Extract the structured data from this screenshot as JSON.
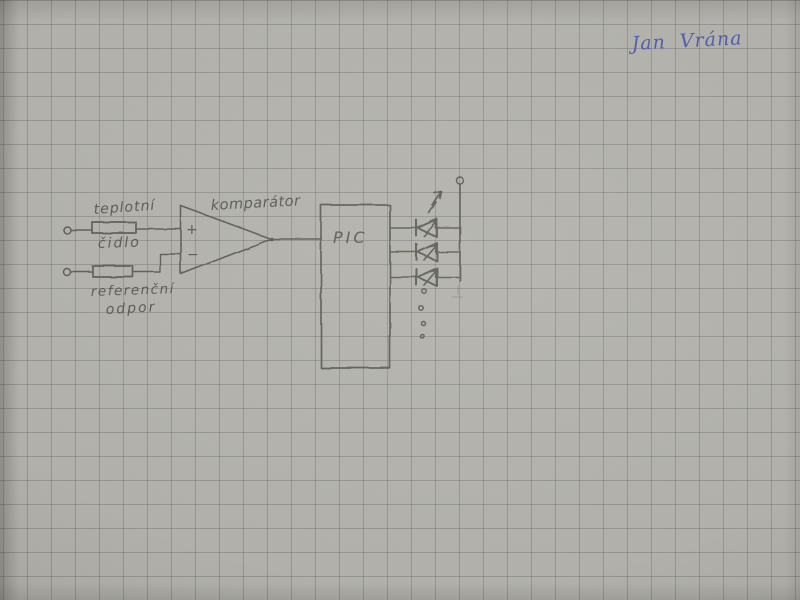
{
  "paper": {
    "type": "squared graph paper photo",
    "background_color": "#b1b0aa",
    "grid_color": "#8f918e",
    "grid_spacing_px": 24
  },
  "colors": {
    "paper": "#b1b0aa",
    "pencil": "#4c4e47",
    "ink": "#4556ac"
  },
  "signature": {
    "text": "Jan Vrána"
  },
  "schematic": {
    "labels": {
      "sensor_line1": "teplotní",
      "sensor_line2": "čidlo",
      "reference_line1": "referenční",
      "reference_line2": "odpor",
      "comparator": "komparátor",
      "plus_input": "+",
      "minus_input": "−",
      "mcu": "PIC"
    },
    "symbols": {
      "input_terminals": 2,
      "resistors": 2,
      "comparator": 1,
      "mcu_box": 1,
      "leds": 3,
      "led_emission_arrows": 4,
      "supply_terminal": 1,
      "ellipsis_dots": 4
    }
  }
}
